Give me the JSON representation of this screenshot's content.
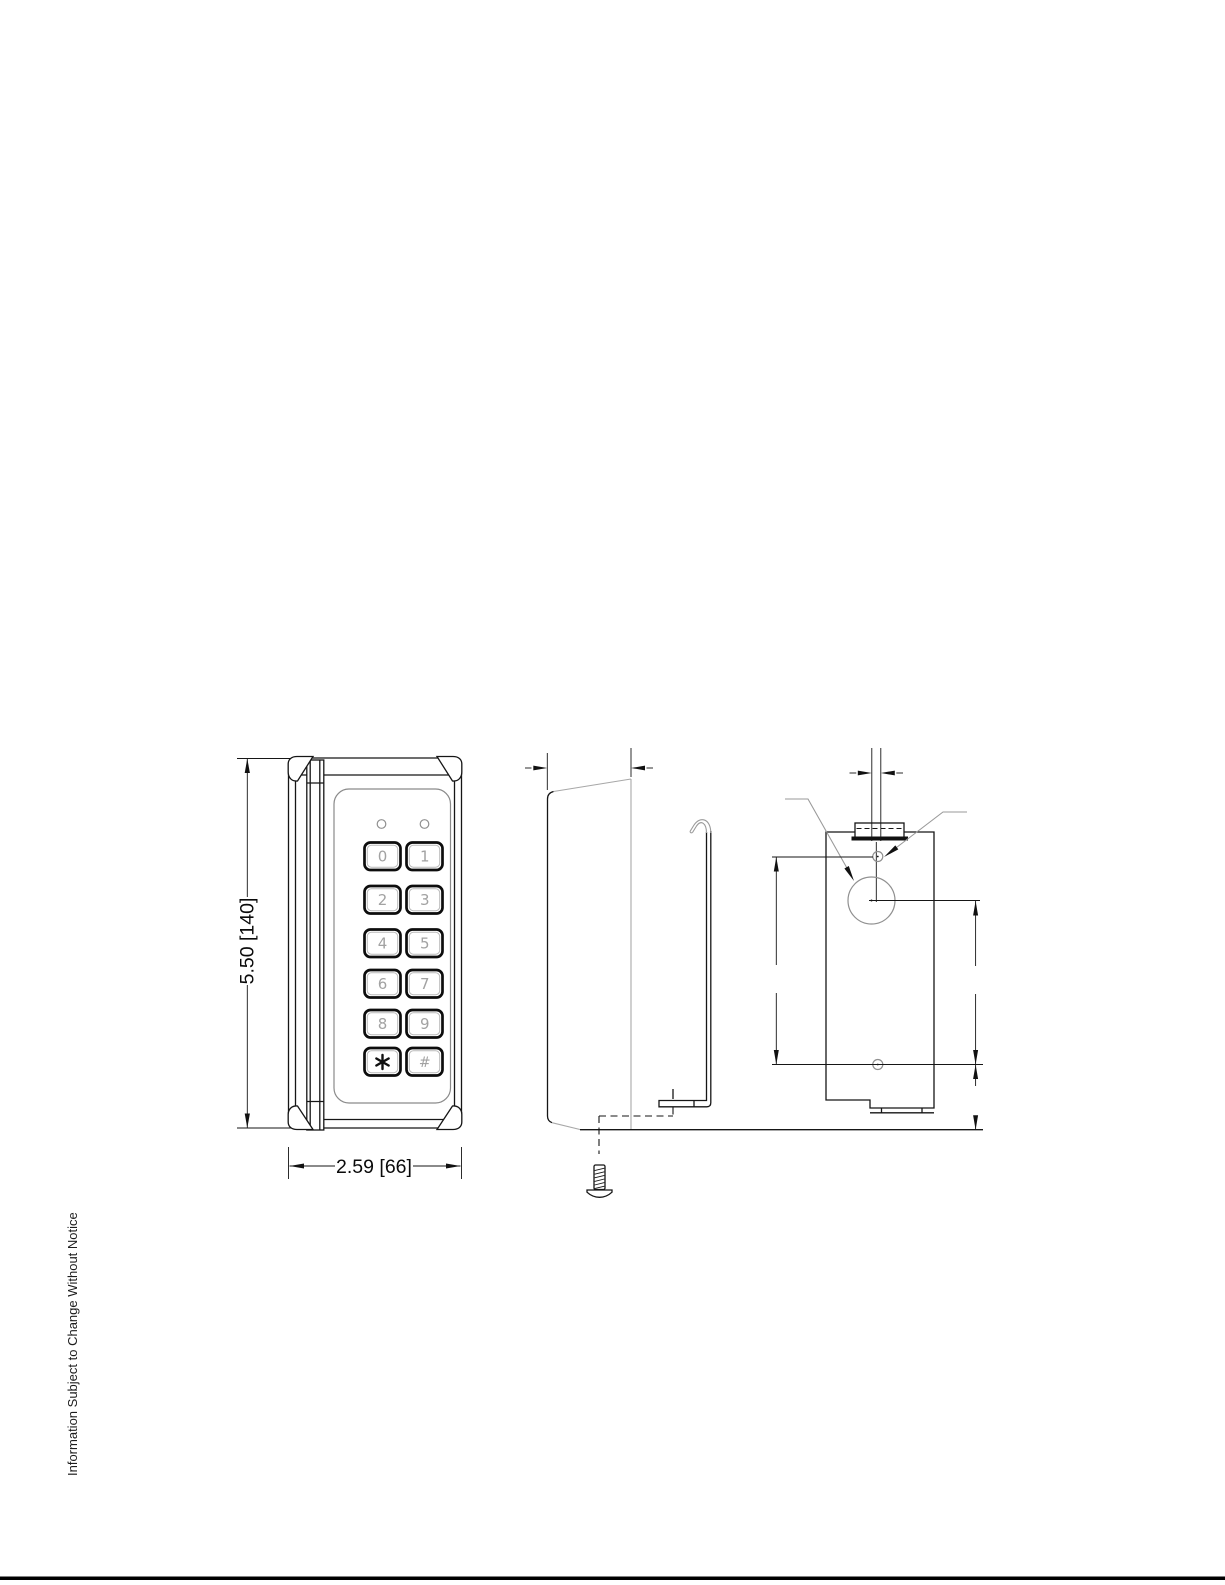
{
  "footer": {
    "notice": "Information Subject to Change Without Notice"
  },
  "front_view": {
    "height_label": "5.50 [140]",
    "width_label": "2.59 [66]",
    "keys": [
      "0",
      "1",
      "2",
      "3",
      "4",
      "5",
      "6",
      "7",
      "8",
      "9",
      "*",
      "#"
    ]
  },
  "colors": {
    "line": "#161616",
    "secondary_line": "#9a9a9a",
    "key_label": "#a2a2a2",
    "background": "#ffffff"
  }
}
